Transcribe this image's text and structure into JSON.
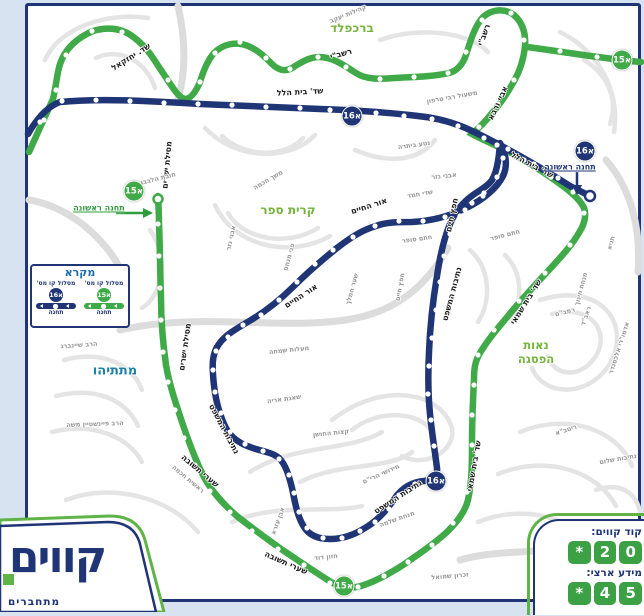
{
  "colors": {
    "route_green": "#3faa47",
    "route_navy": "#1f3576",
    "area_green": "#74b43e",
    "teal": "#1d80a8",
    "legend_title_blue": "#1e6cb0",
    "key_green": "#3ca044",
    "page_bg": "#d8e3f1",
    "map_border_navy": "#1f3576"
  },
  "areas": [
    {
      "text": "ברכפלד",
      "x": 352,
      "y": 28,
      "type": "green",
      "size": 12
    },
    {
      "text": "קרית ספר",
      "x": 288,
      "y": 210,
      "type": "green",
      "size": 12
    },
    {
      "text": "נאות\nהפסגה",
      "x": 536,
      "y": 352,
      "type": "green",
      "size": 11.5
    },
    {
      "text": "מתתיהו",
      "x": 115,
      "y": 371,
      "type": "teal",
      "size": 13
    }
  ],
  "streets": [
    {
      "text": "שד. יחזקאל",
      "x": 131,
      "y": 57,
      "r": -32,
      "cls": "road"
    },
    {
      "text": "שד' בית הלל",
      "x": 300,
      "y": 92,
      "r": -3,
      "cls": "road"
    },
    {
      "text": "שד' בית הלל",
      "x": 532,
      "y": 165,
      "r": 28,
      "cls": "road"
    },
    {
      "text": "מסילת ישרים",
      "x": 167,
      "y": 165,
      "r": -85,
      "cls": "road"
    },
    {
      "text": "מסילת ישרים",
      "x": 185,
      "y": 347,
      "r": -82,
      "cls": "road"
    },
    {
      "text": "רשב\"י",
      "x": 341,
      "y": 54,
      "r": -15,
      "cls": "road"
    },
    {
      "text": "רשב\"י",
      "x": 484,
      "y": 35,
      "r": -70,
      "cls": "road"
    },
    {
      "text": "אביי ורבא",
      "x": 498,
      "y": 103,
      "r": -65,
      "cls": "road"
    },
    {
      "text": "אור החיים",
      "x": 369,
      "y": 206,
      "r": -18,
      "cls": "road"
    },
    {
      "text": "אור החיים",
      "x": 301,
      "y": 296,
      "r": -33,
      "cls": "road"
    },
    {
      "text": "חפץ חיים",
      "x": 452,
      "y": 215,
      "r": -78,
      "cls": "road"
    },
    {
      "text": "חפץ חיים",
      "x": 400,
      "y": 287,
      "r": -80,
      "cls": "minor"
    },
    {
      "text": "נתיבות המשפט",
      "x": 224,
      "y": 429,
      "r": 62,
      "cls": "road"
    },
    {
      "text": "נתיבות המשפט",
      "x": 452,
      "y": 294,
      "r": -75,
      "cls": "road"
    },
    {
      "text": "נתיבות המשפט",
      "x": 398,
      "y": 497,
      "r": -33,
      "cls": "road"
    },
    {
      "text": "שערי תשובה",
      "x": 200,
      "y": 471,
      "r": 40,
      "cls": "road"
    },
    {
      "text": "שערי תשובה",
      "x": 286,
      "y": 563,
      "r": 24,
      "cls": "road"
    },
    {
      "text": "שד' בית שמאי",
      "x": 526,
      "y": 302,
      "r": -58,
      "cls": "road"
    },
    {
      "text": "שד' בית שמאי",
      "x": 474,
      "y": 466,
      "r": -80,
      "cls": "road"
    },
    {
      "text": "קהילות יעקב",
      "x": 348,
      "y": 14,
      "r": -22,
      "cls": "minor"
    },
    {
      "text": "משעול רבי טרפון",
      "x": 452,
      "y": 97,
      "r": -10,
      "cls": "minor"
    },
    {
      "text": "נטע ביתרה",
      "x": 414,
      "y": 145,
      "r": -8,
      "cls": "minor"
    },
    {
      "text": "אבני נזר",
      "x": 444,
      "y": 176,
      "r": -6,
      "cls": "minor"
    },
    {
      "text": "אבני נזר",
      "x": 231,
      "y": 238,
      "r": -78,
      "cls": "minor"
    },
    {
      "text": "משך חכמה",
      "x": 268,
      "y": 180,
      "r": -30,
      "cls": "minor"
    },
    {
      "text": "חובת הלבבות",
      "x": 156,
      "y": 179,
      "r": -14,
      "cls": "minor"
    },
    {
      "text": "שדי חמד",
      "x": 420,
      "y": 194,
      "r": -10,
      "cls": "minor"
    },
    {
      "text": "חתם סופר",
      "x": 417,
      "y": 239,
      "r": -8,
      "cls": "minor"
    },
    {
      "text": "חתם סופר",
      "x": 505,
      "y": 235,
      "r": -14,
      "cls": "minor"
    },
    {
      "text": "פני מנחם",
      "x": 289,
      "y": 257,
      "r": -75,
      "cls": "minor"
    },
    {
      "text": "שער המלך",
      "x": 352,
      "y": 289,
      "r": -75,
      "cls": "minor"
    },
    {
      "text": "מעלות שמחה",
      "x": 289,
      "y": 350,
      "r": -6,
      "cls": "minor"
    },
    {
      "text": "שאגת אריה",
      "x": 284,
      "y": 399,
      "r": -8,
      "cls": "minor"
    },
    {
      "text": "קצות החושן",
      "x": 331,
      "y": 433,
      "r": -6,
      "cls": "minor"
    },
    {
      "text": "ראשית חכמה",
      "x": 188,
      "y": 479,
      "r": 40,
      "cls": "minor"
    },
    {
      "text": "הרב שיינברג",
      "x": 79,
      "y": 345,
      "r": -4,
      "cls": "minor"
    },
    {
      "text": "הרב פיינשטיין משה",
      "x": 95,
      "y": 424,
      "r": -2,
      "cls": "minor"
    },
    {
      "text": "חזון דוד",
      "x": 326,
      "y": 557,
      "r": -6,
      "cls": "minor"
    },
    {
      "text": "אבן עזרא",
      "x": 278,
      "y": 521,
      "r": -70,
      "cls": "minor"
    },
    {
      "text": "מנחת שלמה",
      "x": 397,
      "y": 519,
      "r": -20,
      "cls": "minor"
    },
    {
      "text": "חידושי הרי\"ם",
      "x": 381,
      "y": 474,
      "r": -24,
      "cls": "minor"
    },
    {
      "text": "מנחת חינוך",
      "x": 581,
      "y": 289,
      "r": -75,
      "cls": "minor"
    },
    {
      "text": "רמב\"ם",
      "x": 565,
      "y": 312,
      "r": -14,
      "cls": "minor"
    },
    {
      "text": "ריטב\"א",
      "x": 566,
      "y": 430,
      "r": -18,
      "cls": "minor"
    },
    {
      "text": "נתיבות שלום",
      "x": 618,
      "y": 459,
      "r": -10,
      "cls": "minor"
    },
    {
      "text": "זכרון שמואל",
      "x": 450,
      "y": 576,
      "r": -5,
      "cls": "minor"
    },
    {
      "text": "תניא",
      "x": 611,
      "y": 243,
      "r": -75,
      "cls": "minor"
    },
    {
      "text": "ראב\"ד",
      "x": 586,
      "y": 316,
      "r": -70,
      "cls": "minor"
    },
    {
      "text": "אדמו\"רי אלכסנדר",
      "x": 619,
      "y": 348,
      "r": -72,
      "cls": "minor"
    }
  ],
  "badges": [
    {
      "text": "א15",
      "x": 622,
      "y": 60,
      "variant": "green"
    },
    {
      "text": "א15",
      "x": 134,
      "y": 191,
      "variant": "green"
    },
    {
      "text": "א15",
      "x": 344,
      "y": 586,
      "variant": "green"
    },
    {
      "text": "א16",
      "x": 352,
      "y": 116,
      "variant": "navy"
    },
    {
      "text": "א16",
      "x": 585,
      "y": 151,
      "variant": "navy"
    },
    {
      "text": "א16",
      "x": 436,
      "y": 481,
      "variant": "navy"
    }
  ],
  "first_stations": [
    {
      "text": "תחנה ראשונה",
      "variant": "green",
      "x": 99,
      "y": 208
    },
    {
      "text": "תחנה ראשונה",
      "variant": "navy",
      "x": 570,
      "y": 167
    }
  ],
  "legend": {
    "title": "מקרא",
    "columns": [
      {
        "caption": "מסלול קו מס'",
        "badge": "א15",
        "variant": "green",
        "station": "תחנה"
      },
      {
        "caption": "מסלול קו מס'",
        "badge": "א16",
        "variant": "navy",
        "station": "תחנה"
      }
    ]
  },
  "info_panel": {
    "rows": [
      {
        "label": "קוד קווים:",
        "keys": [
          "*",
          "2",
          "0"
        ]
      },
      {
        "label": "מידע ארצי:",
        "keys": [
          "*",
          "4",
          "5"
        ]
      }
    ]
  },
  "logo": {
    "name": "קווים",
    "tagline": "מתחברים"
  }
}
